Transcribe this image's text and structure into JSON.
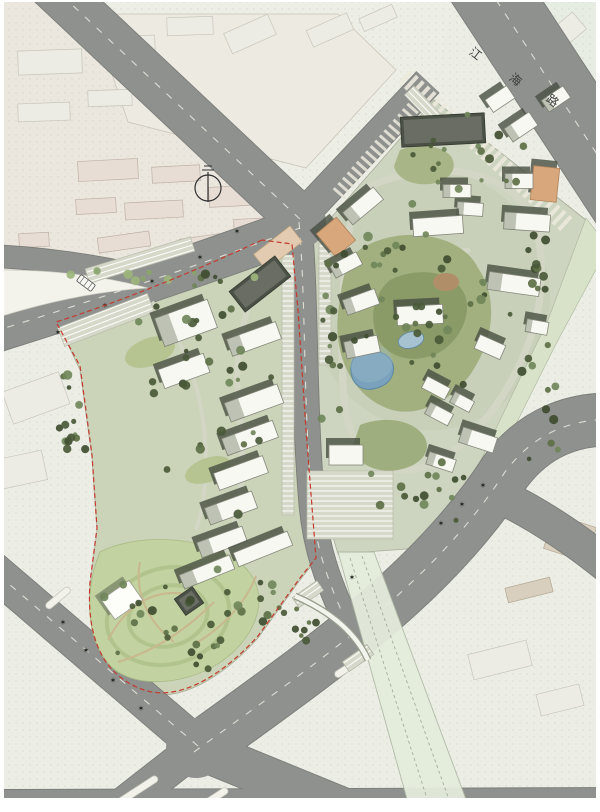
{
  "figure": {
    "title": "residential district master plan",
    "type": "site-plan"
  },
  "map": {
    "palette": {
      "bg": "#eceee6",
      "road": "#8f918f",
      "roadEdge": "#7b7d78",
      "roadDash": "#eceade",
      "shadow": "#474f41",
      "bldgWhite": "#f8f8f3",
      "bldgStroke": "#85877b",
      "bldgDark": "#4b5146",
      "bldgTan": "#d8a77c",
      "parcelEast": "#cdd4c0",
      "parcelWest": "#cbd3b8",
      "greenstrip": "#d8e2c8",
      "parkingBg": "#d6d8c9",
      "pathCol": "#d4d6c5",
      "parkPath": "#c9b88e",
      "pond": "#7ba2bc",
      "pondEdge": "#5b87a3",
      "pool": "#a6c1cf",
      "boundary": "#c43a2c",
      "island": "#f3f3ec",
      "median": "#f2f2ea",
      "pinkFill": "#e8ddd5",
      "pinkStroke": "#bfb1a6",
      "faintFill": "#ededе5",
      "faintStroke": "#c8c5b9",
      "beigeFill": "#d9cfbe",
      "beigeStroke": "#b3a791",
      "canal": "#e4ecdc",
      "canalEdge": "#aeb8a4",
      "speckle": "#3c4632"
    },
    "zones": [
      {
        "name": "context-pink-zone",
        "d": "M 0,0 L 70,0 L 292,200 L 292,238 L 158,274 L 0,320 Z",
        "fill": "#ebe7df"
      },
      {
        "name": "context-top-middle",
        "d": "M 70,0 L 452,0 L 434,100 L 312,216 L 296,206 Z",
        "fill": "#edefe6"
      },
      {
        "name": "context-top-right",
        "d": "M 540,0 L 600,0 L 600,120 Z",
        "fill": "#e7ede2"
      }
    ],
    "field_outline": {
      "d": "M 92,14 L 338,14 L 396,70 L 306,168 L 128,122 Z",
      "fill": "#edeae2",
      "stroke": "#c9c5b8"
    },
    "context_buildings": {
      "pink": [
        [
          108,
          170,
          60,
          20,
          -3
        ],
        [
          176,
          174,
          48,
          16,
          -3
        ],
        [
          96,
          206,
          40,
          15,
          -3
        ],
        [
          154,
          210,
          58,
          17,
          -3
        ],
        [
          236,
          196,
          54,
          20,
          -3
        ],
        [
          254,
          226,
          40,
          15,
          -3
        ],
        [
          124,
          242,
          52,
          15,
          -8
        ],
        [
          200,
          244,
          40,
          15,
          -8
        ],
        [
          34,
          240,
          30,
          14,
          -3
        ],
        [
          60,
          275,
          34,
          13,
          -12
        ]
      ],
      "faint": [
        [
          50,
          62,
          64,
          24,
          -2
        ],
        [
          128,
          46,
          54,
          20,
          -2
        ],
        [
          190,
          26,
          46,
          18,
          -2
        ],
        [
          44,
          112,
          52,
          18,
          -2
        ],
        [
          110,
          98,
          44,
          16,
          -2
        ],
        [
          250,
          34,
          48,
          22,
          -24
        ],
        [
          330,
          30,
          44,
          18,
          -24
        ],
        [
          378,
          18,
          36,
          14,
          -24
        ],
        [
          568,
          30,
          30,
          22,
          -40
        ],
        [
          36,
          398,
          60,
          34,
          -20
        ],
        [
          20,
          470,
          50,
          30,
          -12
        ],
        [
          500,
          660,
          60,
          26,
          -14
        ],
        [
          560,
          700,
          44,
          22,
          -14
        ]
      ],
      "beige": [
        [
          570,
          538,
          44,
          36,
          18
        ],
        [
          529,
          590,
          46,
          15,
          -14
        ]
      ]
    },
    "parcels": {
      "west": {
        "d": "M 288,242 L 60,328 L 80,370 L 92,458 L 97,530 L 90,585 C 86,642 104,678 144,692 C 180,704 224,676 258,638 L 300,580 L 316,560 L 306,440 L 298,310 L 292,242 Z"
      },
      "east": {
        "d": "M 315,236 L 434,100 L 586,220 L 552,318 L 467,508 L 420,548 L 338,554 L 322,500 L 314,380 L 310,240 Z"
      },
      "greenstrip": {
        "d": "M 586,218 L 600,236 L 600,262 L 556,344 L 470,516 L 458,508 L 548,320 Z"
      }
    },
    "roads": {
      "segments": [
        {
          "name": "jianghai-road",
          "d": "M 470,-40 L 644,226",
          "w": 76,
          "dash": true
        },
        {
          "name": "northwest-road",
          "d": "M 50,-16 L 303,222",
          "w": 46,
          "dash": true
        },
        {
          "name": "west-road-slip",
          "d": "M -8,256 Q 80,260 172,284",
          "w": 22,
          "dash": false
        },
        {
          "name": "west-road",
          "d": "M -8,332 Q 150,283 300,228",
          "w": 42,
          "dash": true
        },
        {
          "name": "ne-connector-road",
          "d": "M 300,218 L 428,82",
          "w": 30,
          "dash": false
        },
        {
          "name": "central-road",
          "d": "M 299,222 C 306,300 303,400 312,505 C 316,550 330,585 342,612",
          "w": 25,
          "dash": true
        },
        {
          "name": "grand-avenue",
          "d": "M 194,752 C 312,666 432,586 505,472 Q 548,414 624,420",
          "w": 52,
          "dash": true
        },
        {
          "name": "avenue-branch",
          "d": "M 500,496 Q 558,524 618,574",
          "w": 34,
          "dash": false
        },
        {
          "name": "southeast-arm",
          "d": "M 196,748 L 382,824",
          "w": 40,
          "dash": false
        },
        {
          "name": "southwest-arm",
          "d": "M 196,748 L 96,826",
          "w": 34,
          "dash": false
        },
        {
          "name": "northwest-arm",
          "d": "M 198,746 L -12,566",
          "w": 36,
          "dash": true
        },
        {
          "name": "bottom-road",
          "d": "M -8,802 L 608,800",
          "w": 24,
          "dash": true
        }
      ],
      "junctions": [
        [
          300,
          222,
          26
        ],
        [
          196,
          748,
          30
        ]
      ],
      "island": {
        "d": "M 2,270 Q 80,270 148,288 Q 80,292 2,316 Z"
      }
    },
    "crosswalks": [
      {
        "name": "entry-paving-jianghai",
        "d": "M 404,76 L 568,226",
        "w": 18,
        "color": "#ece9dd",
        "dash": "4 4"
      },
      {
        "name": "entry-paving-connector",
        "d": "M 338,194 L 420,100",
        "w": 14,
        "color": "#e8e5d8",
        "dash": "3 4"
      }
    ],
    "canal": {
      "d": "M 338,552 L 374,552 L 470,810 L 410,810 Z",
      "lines": [
        "M 350,558 L 430,808",
        "M 362,556 L 452,808"
      ]
    },
    "bridge": {
      "d": "M 295,596 Q 350,620 368,660"
    },
    "ramps": [
      [
        308,
        594,
        30,
        12,
        -35
      ],
      [
        358,
        658,
        30,
        12,
        -35
      ]
    ],
    "medians": [
      [
        352,
        665,
        40,
        -33
      ],
      [
        138,
        790,
        46,
        -33
      ],
      [
        214,
        798,
        32,
        -33
      ],
      [
        58,
        598,
        30,
        -40
      ]
    ],
    "inner_paths": {
      "east_loop": "M 380,182 C 440,160 498,172 524,204 C 548,238 545,300 529,342 C 509,396 469,450 427,466 C 393,478 357,462 348,422 C 339,382 341,300 346,256 C 350,215 355,192 380,182 Z",
      "east_cross1": "M 345,255 C 380,262 420,258 470,250",
      "east_cross2": "M 352,352 C 390,352 420,345 470,340",
      "west_main": "M 272,262 C 242,300 232,360 240,420 C 246,468 240,520 224,552",
      "west_branch": "M 152,302 C 180,332 198,378 204,428 C 208,462 206,500 196,530"
    },
    "park": {
      "blob": "M 100,552 C 140,532 200,538 230,556 C 265,576 268,612 240,645 C 210,680 150,692 118,672 C 90,654 80,600 100,552 Z",
      "fill": "#c2d2a0",
      "rings": [
        [
          168,
          616,
          62,
          48,
          -15
        ],
        [
          168,
          616,
          40,
          30,
          -15
        ]
      ],
      "paths": [
        "M 108,640 C 128,602 158,586 194,596",
        "M 118,662 C 152,652 184,632 214,602",
        "M 140,562 C 134,592 148,622 174,642",
        "M 198,642 C 224,626 246,602 256,576"
      ]
    },
    "lawns": [
      {
        "d": "M 362,248 C 402,224 462,234 478,268 C 500,300 492,342 472,372 C 452,402 412,422 382,406 C 348,390 334,350 338,314 C 342,282 344,260 362,248 Z",
        "fill": "#a2b080"
      },
      {
        "d": "M 390,280 C 420,265 455,272 465,295 C 472,315 460,340 440,352 C 418,364 392,360 380,342 C 368,322 372,295 390,280 Z",
        "fill": "#8a9b68"
      },
      {
        "d": "M 400,150 C 420,142 445,146 452,158 C 458,170 448,182 430,184 C 412,186 396,178 394,166 Z",
        "fill": "#a8b587"
      },
      {
        "d": "M 360,425 C 385,415 415,420 425,438 C 432,452 420,466 398,470 C 375,474 355,462 352,448 Z",
        "fill": "#9fae7e"
      }
    ],
    "lawn_ellipses": [
      [
        150,
        352,
        26,
        14,
        -20
      ],
      [
        208,
        470,
        24,
        12,
        -20
      ],
      [
        446,
        282,
        13,
        9,
        0
      ]
    ],
    "lawn_ellipse_fills": [
      "#b6c492",
      "#b6c492",
      "#b08f68"
    ],
    "parking": [
      [
        106,
        320,
        96,
        20,
        -21
      ],
      [
        140,
        260,
        110,
        15,
        -17
      ],
      [
        350,
        505,
        86,
        68,
        0
      ],
      [
        288,
        385,
        12,
        260,
        0
      ],
      [
        325,
        300,
        12,
        130,
        0
      ],
      [
        430,
        112,
        60,
        13,
        46
      ]
    ],
    "plazas": [
      [
        278,
        248,
        46,
        20,
        -38
      ]
    ],
    "water": {
      "pond": "M 352,362 C 355,352 370,348 380,352 C 392,356 396,366 392,376 C 388,386 372,392 362,388 C 352,384 349,372 352,362 Z",
      "pool": [
        411,
        340,
        13,
        8,
        -15
      ]
    },
    "buildings": [
      [
        443,
        130,
        84,
        30,
        -3,
        "d"
      ],
      [
        500,
        99,
        26,
        15,
        -34,
        "w"
      ],
      [
        521,
        127,
        30,
        16,
        -34,
        "w"
      ],
      [
        556,
        99,
        26,
        14,
        -34,
        "w"
      ],
      [
        545,
        184,
        26,
        34,
        6,
        "t"
      ],
      [
        527,
        222,
        46,
        17,
        4,
        "w"
      ],
      [
        470,
        209,
        26,
        13,
        4,
        "w"
      ],
      [
        438,
        226,
        50,
        18,
        -4,
        "w"
      ],
      [
        457,
        191,
        28,
        13,
        0,
        "w"
      ],
      [
        363,
        206,
        40,
        16,
        -40,
        "w"
      ],
      [
        336,
        237,
        26,
        30,
        -40,
        "t"
      ],
      [
        346,
        265,
        30,
        14,
        -28,
        "w"
      ],
      [
        361,
        302,
        34,
        16,
        -20,
        "w"
      ],
      [
        420,
        315,
        46,
        19,
        -3,
        "w"
      ],
      [
        514,
        284,
        52,
        18,
        8,
        "w"
      ],
      [
        519,
        181,
        28,
        15,
        0,
        "w"
      ],
      [
        490,
        347,
        28,
        15,
        24,
        "w"
      ],
      [
        537,
        327,
        22,
        13,
        10,
        "w"
      ],
      [
        362,
        347,
        34,
        17,
        -12,
        "w"
      ],
      [
        436,
        388,
        26,
        13,
        28,
        "w"
      ],
      [
        439,
        414,
        26,
        13,
        28,
        "w"
      ],
      [
        462,
        402,
        22,
        12,
        28,
        "w"
      ],
      [
        346,
        455,
        34,
        20,
        0,
        "w"
      ],
      [
        478,
        440,
        36,
        16,
        18,
        "w"
      ],
      [
        441,
        462,
        28,
        13,
        18,
        "w"
      ],
      [
        260,
        284,
        58,
        26,
        -38,
        "d"
      ],
      [
        186,
        323,
        56,
        30,
        -20,
        "w"
      ],
      [
        254,
        339,
        52,
        18,
        -20,
        "w"
      ],
      [
        184,
        371,
        48,
        20,
        -20,
        "w"
      ],
      [
        254,
        403,
        56,
        20,
        -20,
        "w"
      ],
      [
        250,
        438,
        54,
        18,
        -20,
        "w"
      ],
      [
        241,
        473,
        52,
        18,
        -20,
        "w"
      ],
      [
        231,
        508,
        50,
        18,
        -20,
        "w"
      ],
      [
        222,
        542,
        48,
        16,
        -20,
        "w"
      ],
      [
        122,
        600,
        34,
        24,
        -35,
        "k"
      ],
      [
        189,
        601,
        22,
        20,
        -35,
        "d"
      ],
      [
        207,
        572,
        54,
        15,
        -22,
        "w"
      ],
      [
        263,
        549,
        58,
        15,
        -22,
        "w"
      ]
    ],
    "trees": {
      "palette": [
        "#4a5a38",
        "#5d7046",
        "#70875a",
        "#3f4d30"
      ],
      "light_palette": [
        "#9db57c",
        "#8aa46c"
      ],
      "clusters": [
        [
          72,
          425,
          16,
          90,
          15,
          7,
          "D"
        ],
        [
          168,
          618,
          78,
          62,
          26,
          13,
          "D"
        ],
        [
          218,
          405,
          70,
          130,
          22,
          21,
          "D"
        ],
        [
          196,
          302,
          68,
          36,
          12,
          5,
          "D"
        ],
        [
          424,
          318,
          85,
          90,
          28,
          9,
          "D"
        ],
        [
          472,
          162,
          85,
          55,
          18,
          11,
          "D"
        ],
        [
          418,
          482,
          75,
          40,
          15,
          3,
          "D"
        ],
        [
          332,
          352,
          12,
          115,
          13,
          17,
          "D"
        ],
        [
          532,
          402,
          36,
          105,
          12,
          19,
          "D"
        ],
        [
          543,
          282,
          26,
          55,
          10,
          23,
          "D"
        ],
        [
          152,
          277,
          125,
          14,
          9,
          29,
          "L"
        ],
        [
          262,
          602,
          55,
          35,
          10,
          31,
          "D"
        ],
        [
          382,
          246,
          40,
          25,
          8,
          37,
          "D"
        ],
        [
          300,
          628,
          30,
          25,
          8,
          41,
          "D"
        ]
      ],
      "street_symbol": "✶",
      "street_positions": [
        [
          58,
          332
        ],
        [
          105,
          305
        ],
        [
          152,
          281
        ],
        [
          200,
          257
        ],
        [
          237,
          231
        ],
        [
          483,
          485
        ],
        [
          462,
          504
        ],
        [
          441,
          523
        ],
        [
          63,
          622
        ],
        [
          86,
          650
        ],
        [
          113,
          680
        ],
        [
          141,
          708
        ],
        [
          352,
          577
        ],
        [
          300,
          806
        ],
        [
          420,
          806
        ]
      ]
    },
    "boundary": {
      "d": "M 262,240 Q 150,292 56,322 L 80,366 L 92,455 L 97,528 L 90,582 C 86,640 104,676 144,690 C 180,702 224,674 258,636 L 300,578 L 316,558 L 306,430 L 298,310 L 292,244 Z"
    },
    "labels": {
      "road_name_chars": [
        "江",
        "海",
        "路"
      ],
      "road_name_positions": [
        [
          473,
          57,
          38
        ],
        [
          513,
          83,
          38
        ],
        [
          550,
          104,
          38
        ]
      ],
      "font_size": 12,
      "color": "#3c3c3c"
    },
    "north_arrow": {
      "cx": 208,
      "cy": 188,
      "r": 13
    },
    "bus": {
      "x": 86,
      "y": 283,
      "rot": 37
    }
  }
}
